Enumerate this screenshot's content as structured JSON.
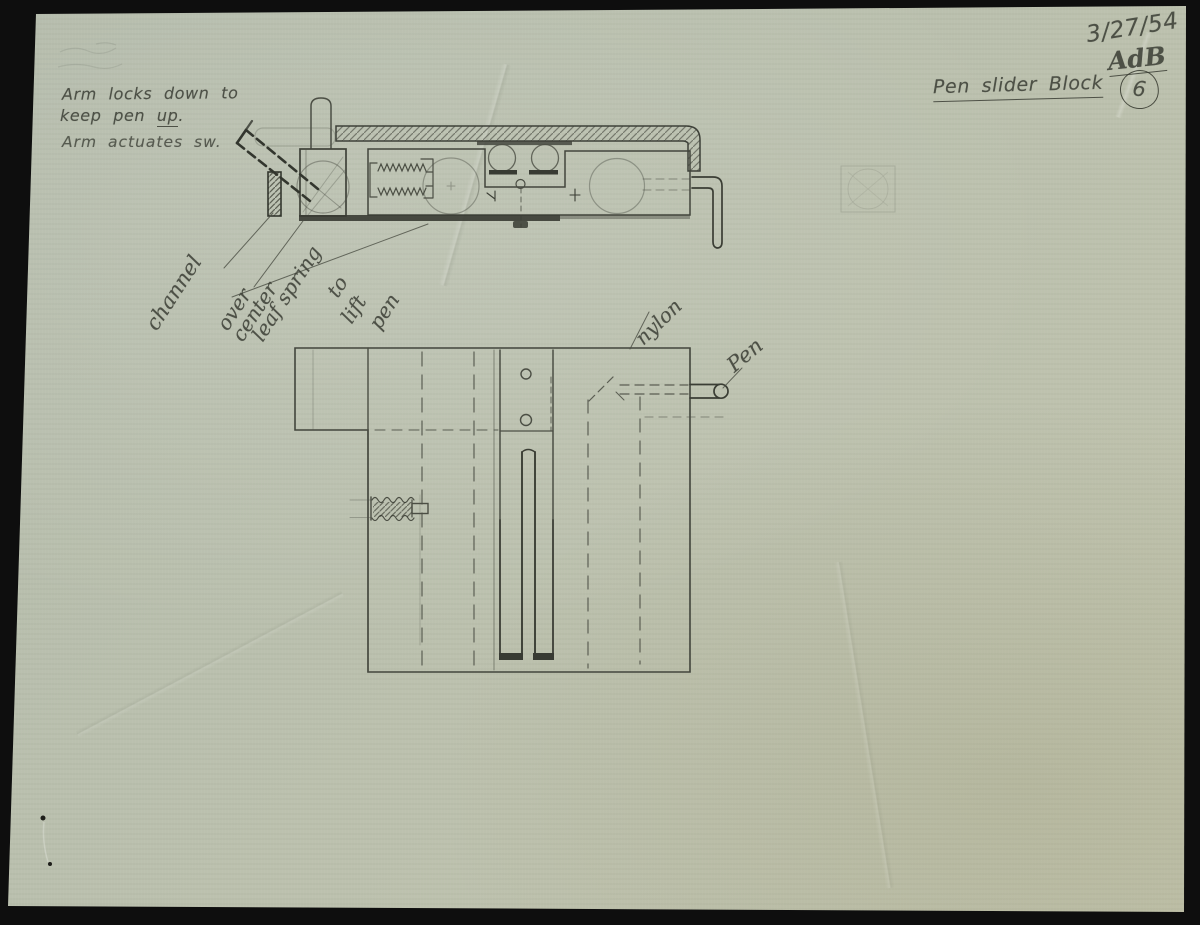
{
  "page": {
    "date": "3/27/54",
    "initials": "AdB",
    "sheet_number": "6",
    "title": "Pen slider Block"
  },
  "notes": {
    "line1": "Arm locks down to",
    "line2_prefix": "keep pen",
    "line2_underlined": "up",
    "line2_suffix": ".",
    "line3": "Arm actuates sw."
  },
  "annotations": {
    "channel": "channel",
    "over": "over",
    "center": "center",
    "leaf_spring": "leaf spring",
    "to": "to",
    "lift": "lift",
    "pen_lower": "pen",
    "nylon": "nylon",
    "pen": "Pen"
  },
  "colors": {
    "paper": "#b9bfae",
    "pencil": "#4b4e44",
    "pencil_dark": "#34372e",
    "scan_background": "#0e0e0e"
  }
}
